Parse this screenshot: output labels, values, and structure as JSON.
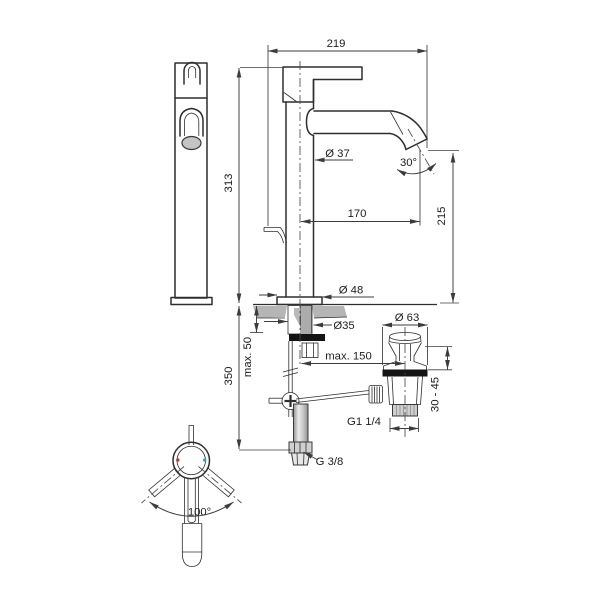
{
  "drawing": {
    "title": "basin mixer technical dimension drawing",
    "subject": "single-lever tall vessel basin mixer with pop-up waste and flexible supply hose",
    "views": [
      "front-view",
      "side-view",
      "top-view",
      "waste-assembly"
    ],
    "dimensions": {
      "total_projection": "219",
      "total_height": "313",
      "body_diameter": "Ø 37",
      "spout_outlet_angle": "30°",
      "spout_reach": "170",
      "outlet_height": "215",
      "base_diameter": "Ø 48",
      "shank_diameter": "Ø35",
      "deck_thickness_max": "max. 50",
      "hose_length": "350",
      "waste_distance_max": "max. 150",
      "waste_cap_diameter": "Ø 63",
      "waste_clamp_range": "30 - 45",
      "waste_outlet_thread": "G1 1/4",
      "supply_thread": "G 3/8",
      "handle_swivel_angle": "100°"
    },
    "colors": {
      "line": "#2e2e2e",
      "hot_marker": "#c0392b",
      "cold_marker": "#2aa8b8",
      "gasket": "#141414",
      "deck_section_fill": "#b5b5b5",
      "aerator_fill": "#c4c4c4",
      "background": "#ffffff"
    }
  }
}
